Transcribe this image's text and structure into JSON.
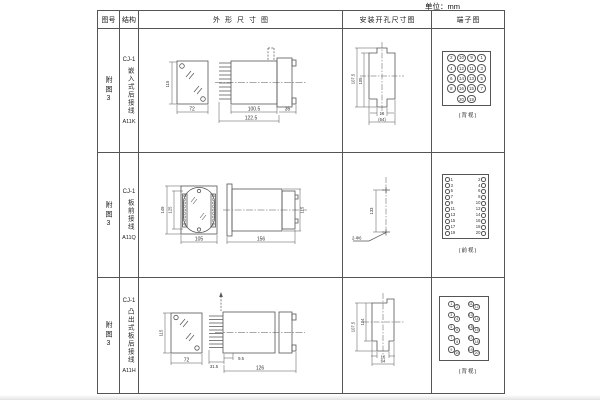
{
  "unit_label": "单位：mm",
  "headers": {
    "figure_no": "图号",
    "structure": "结构",
    "outline": "外形尺寸图",
    "install": "安装开孔尺寸图",
    "terminal": "端子图"
  },
  "rows": [
    {
      "figure_no": "附图3",
      "model": "CJ-1",
      "mounting": "嵌入式后接线",
      "code": "A11K",
      "outline": {
        "h": "115",
        "w": "72",
        "l1": "100.5",
        "l2": "122.5",
        "l3": "35"
      },
      "install": {
        "d1": "107.5",
        "d2": "105",
        "d3": "16",
        "d4": "(64)"
      },
      "terminal": {
        "caption": "(背视)",
        "grid": [
          [
            "2",
            "10",
            "9",
            "1"
          ],
          [
            "4",
            "12",
            "11",
            "3"
          ],
          [
            "6",
            "14",
            "13",
            "5"
          ],
          [
            "8",
            "16",
            "15",
            "7"
          ]
        ],
        "bottom": [
          "20",
          "19"
        ]
      }
    },
    {
      "figure_no": "附图3",
      "model": "CJ-1",
      "mounting": "板前接线",
      "code": "A11Q",
      "outline": {
        "h1": "149",
        "h2": "125",
        "w": "105",
        "l": "156",
        "h3": "115"
      },
      "install": {
        "d1": "133",
        "d2": "2-Φ6"
      },
      "terminal": {
        "caption": "(前视)",
        "left": [
          "1",
          "3",
          "5",
          "7",
          "9",
          "11",
          "13",
          "15",
          "17",
          "19"
        ],
        "right": [
          "2",
          "4",
          "6",
          "8",
          "10",
          "12",
          "14",
          "16",
          "18",
          "20"
        ]
      }
    },
    {
      "figure_no": "附图3",
      "model": "CJ-1",
      "mounting": "凸出式板后接线",
      "code": "A11H",
      "outline": {
        "h": "115",
        "w": "72",
        "l1": "31.5",
        "l2": "9.5",
        "l3": "126"
      },
      "install": {
        "d1": "107.5",
        "d2": "104",
        "d3": "16",
        "d4": "64"
      },
      "terminal": {
        "caption": "(背视)",
        "left": [
          "1",
          "2",
          "3",
          "4",
          "5",
          "6",
          "7",
          "8",
          "9",
          "10"
        ],
        "right": [
          "11",
          "12",
          "13",
          "14",
          "15",
          "16",
          "17",
          "18",
          "19",
          "20"
        ]
      }
    }
  ]
}
